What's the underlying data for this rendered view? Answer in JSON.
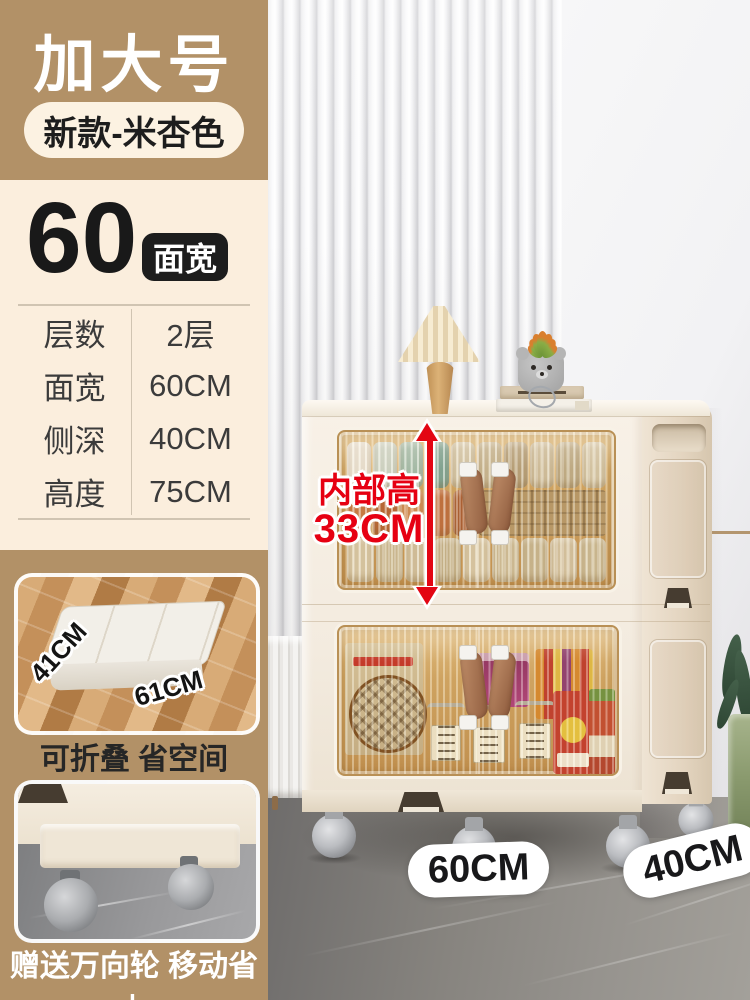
{
  "product_card": {
    "size_tag": "加大号",
    "variant_tag": "新款-米杏色",
    "width_number": "60",
    "width_unit_label": "面宽",
    "spec_table": {
      "rows": [
        {
          "label": "层数",
          "value": "2层"
        },
        {
          "label": "面宽",
          "value": "60CM"
        },
        {
          "label": "侧深",
          "value": "40CM"
        },
        {
          "label": "高度",
          "value": "75CM"
        }
      ]
    },
    "fold_inset": {
      "side_dim": "41CM",
      "front_dim": "61CM"
    },
    "fold_caption": "可折叠 省空间",
    "wheels_caption": "赠送万向轮 移动省力"
  },
  "photo_overlays": {
    "inner_height_line1": "内部高",
    "inner_height_line2": "33CM",
    "width_pill": "60CM",
    "depth_pill": "40CM"
  },
  "palette": {
    "tan": "#b29167",
    "cream_panel": "#fbeedd",
    "pill_cream": "#fcf2e2",
    "badge_black": "#1d1d1d",
    "accent_red": "#e60012",
    "amber_glass": "#c99a5c",
    "cabinet_body": "#f5eee3",
    "floor_gray": "#8b8884"
  }
}
